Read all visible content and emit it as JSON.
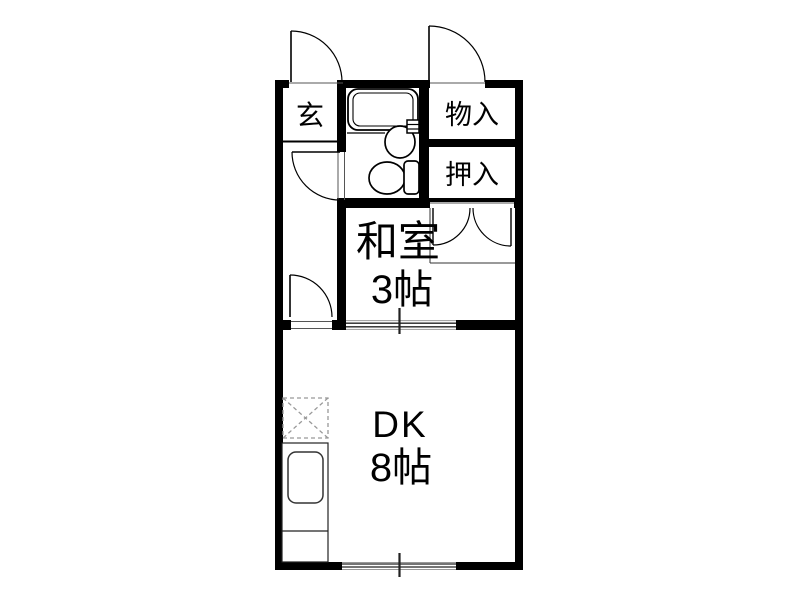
{
  "plan": {
    "kind": "apartment-floor-plan",
    "rooms": {
      "genkan": {
        "label": "玄"
      },
      "storage": {
        "label": "物入"
      },
      "closet": {
        "label": "押入"
      },
      "washitsu": {
        "label": "和室",
        "size": "3帖"
      },
      "dk": {
        "label": "DK",
        "size": "8帖"
      }
    },
    "colors": {
      "wall": "#000000",
      "line": "#111111",
      "thin_edge": "#8a8a8a",
      "dash": "#999999",
      "background": "#ffffff"
    }
  }
}
